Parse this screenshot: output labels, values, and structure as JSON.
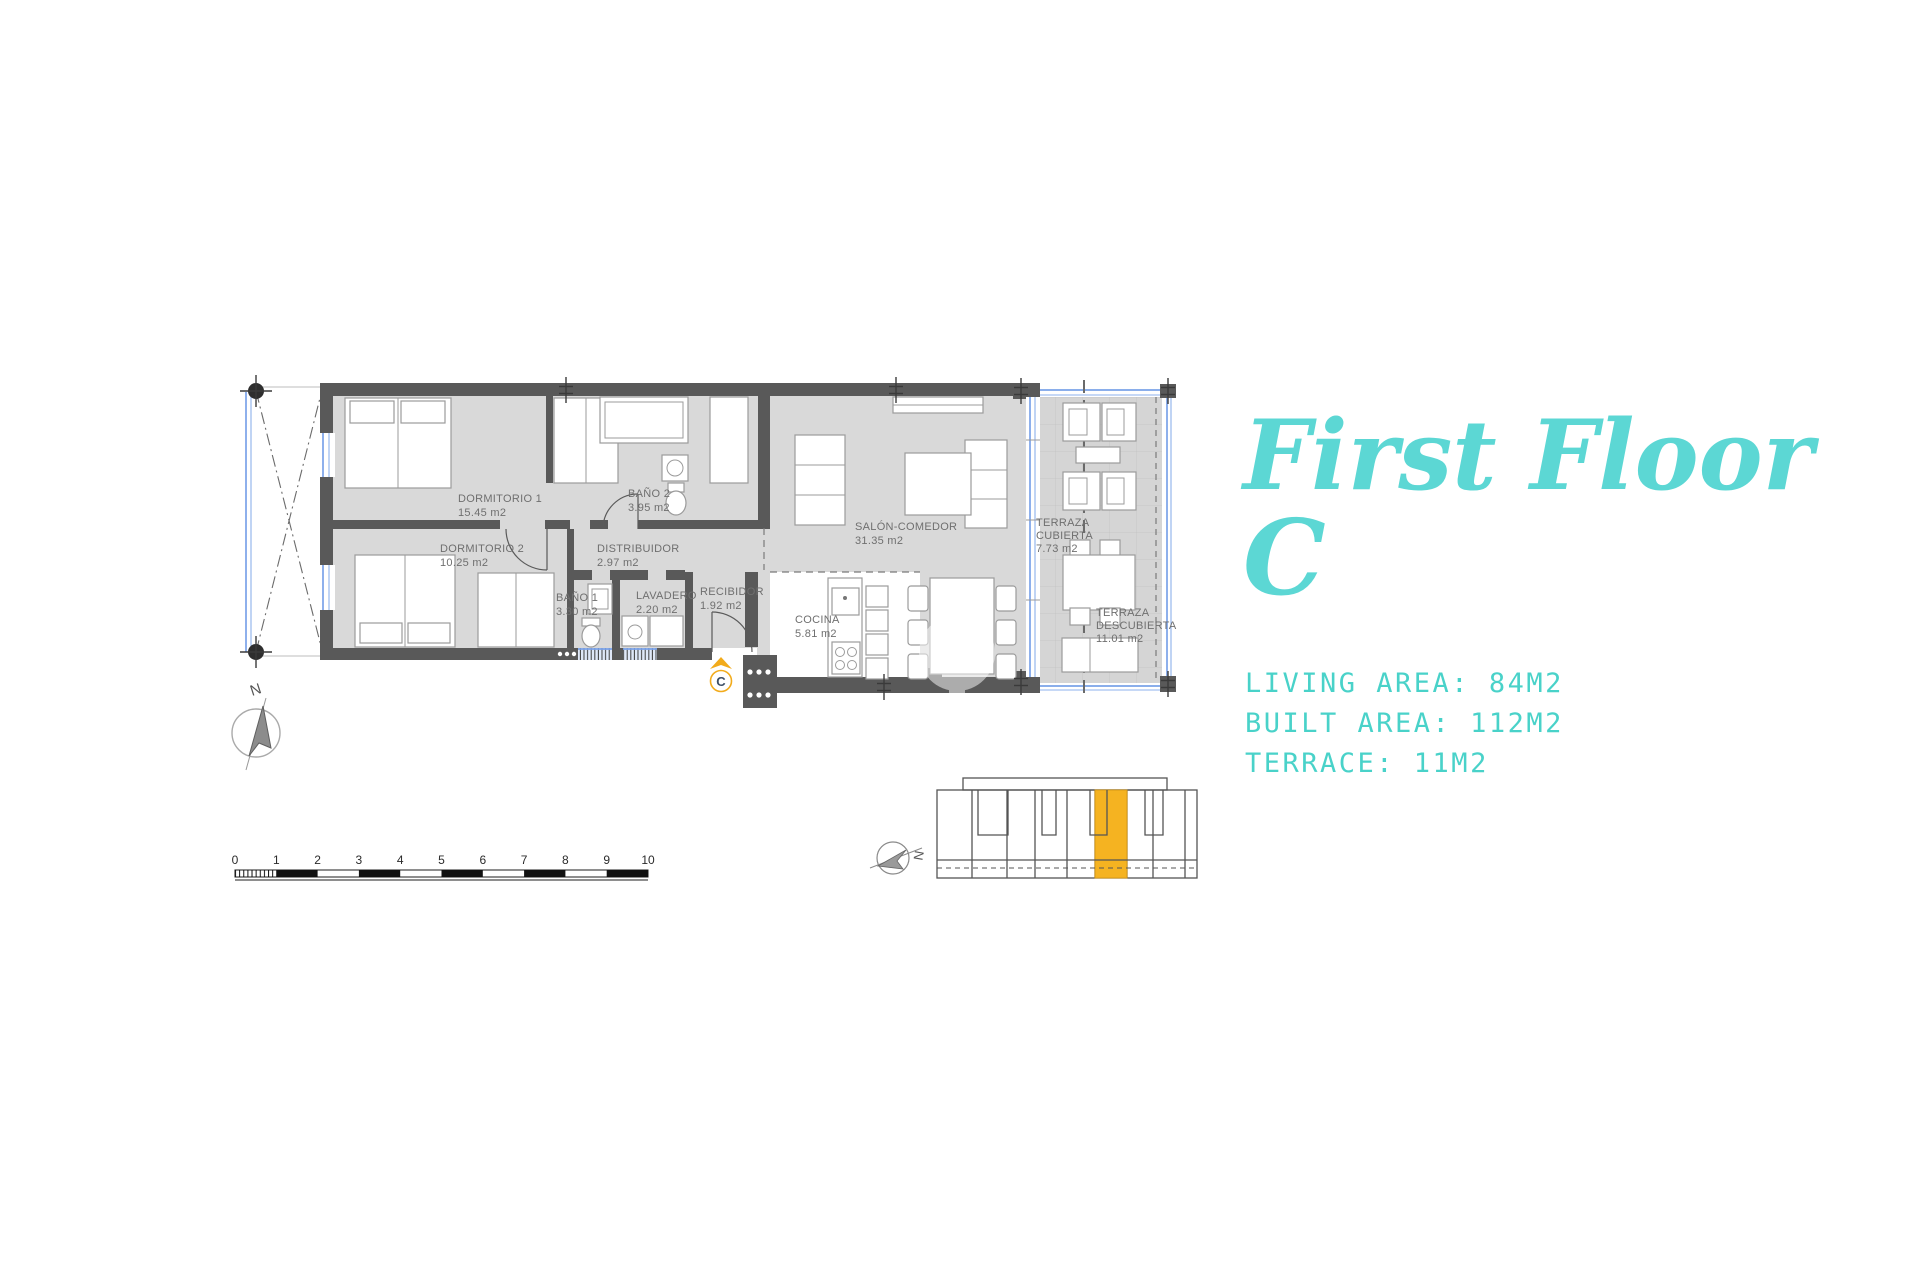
{
  "title": {
    "line1": "First Floor",
    "line2": "C"
  },
  "stats": {
    "living": "LIVING AREA: 84M2",
    "built": "BUILT AREA: 112M2",
    "terrace": "TERRACE: 11M2"
  },
  "unit_letter": "C",
  "compass": {
    "north": "N",
    "locator_north": "N"
  },
  "rooms": [
    {
      "name": "DORMITORIO 1",
      "area": "15.45 m2"
    },
    {
      "name": "DORMITORIO 2",
      "area": "10.25 m2"
    },
    {
      "name": "BAÑO 2",
      "area": "3.95 m2"
    },
    {
      "name": "BAÑO 1",
      "area": "3.30 m2"
    },
    {
      "name": "DISTRIBUIDOR",
      "area": "2.97 m2"
    },
    {
      "name": "LAVADERO",
      "area": "2.20 m2"
    },
    {
      "name": "RECIBIDOR",
      "area": "1.92 m2"
    },
    {
      "name": "COCINA",
      "area": "5.81 m2"
    },
    {
      "name": "SALÓN-COMEDOR",
      "area": "31.35 m2"
    },
    {
      "name": "TERRAZA",
      "name2": "CUBIERTA",
      "area": "7.73 m2"
    },
    {
      "name": "TERRAZA",
      "name2": "DESCUBIERTA",
      "area": "11.01 m2"
    }
  ],
  "scale": {
    "labels": [
      "0",
      "1",
      "2",
      "3",
      "4",
      "5",
      "6",
      "7",
      "8",
      "9",
      "10"
    ]
  },
  "colors": {
    "accent_teal": "#5CD7D4",
    "stats_teal": "#49D2C9",
    "accent_orange": "#F5B321",
    "wall_gray": "#595959",
    "floor_gray": "#D9D9D9",
    "window_blue": "#7AA2E8"
  }
}
